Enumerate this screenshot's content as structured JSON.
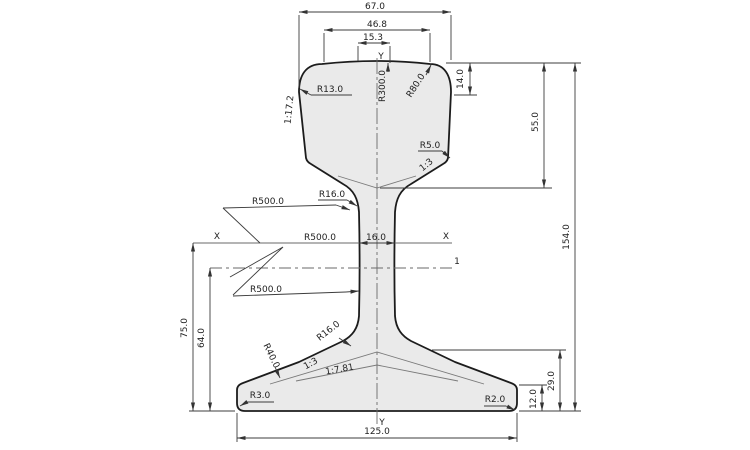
{
  "drawing": {
    "axes": {
      "y_top": "Y",
      "y_bottom": "Y",
      "x_left": "X",
      "x_right": "X",
      "section": "1"
    },
    "dims": {
      "head_width": "67.0",
      "head_top_width": "46.8",
      "crown_width": "15.3",
      "head_side_height": "14.0",
      "head_height": "55.0",
      "total_height": "154.0",
      "foot_slope_height": "29.0",
      "foot_edge_height": "12.0",
      "foot_width": "125.0",
      "neutral_axis_height": "75.0",
      "section_line_height": "64.0",
      "web_thickness": "16.0"
    },
    "radii": {
      "head_corner": "R13.0",
      "crown": "R300.0",
      "shoulder": "R80.0",
      "underhead": "R5.0",
      "web_fillet_top": "R16.0",
      "web_face_upper": "R500.0",
      "web_face_mid": "R500.0",
      "web_face_lower": "R500.0",
      "web_fillet_bottom": "R16.0",
      "foot_blend": "R40.0",
      "foot_corner_left": "R3.0",
      "foot_corner_right": "R2.0"
    },
    "slopes": {
      "head_side": "1:17.2",
      "underhead": "1:3",
      "foot_inner": "1:3",
      "foot_outer": "1:7.81"
    },
    "colors": {
      "background": "#ffffff",
      "fill": "#eaeaea",
      "outline": "#1c1c1c",
      "dim_lines": "#3c3c3c"
    }
  }
}
